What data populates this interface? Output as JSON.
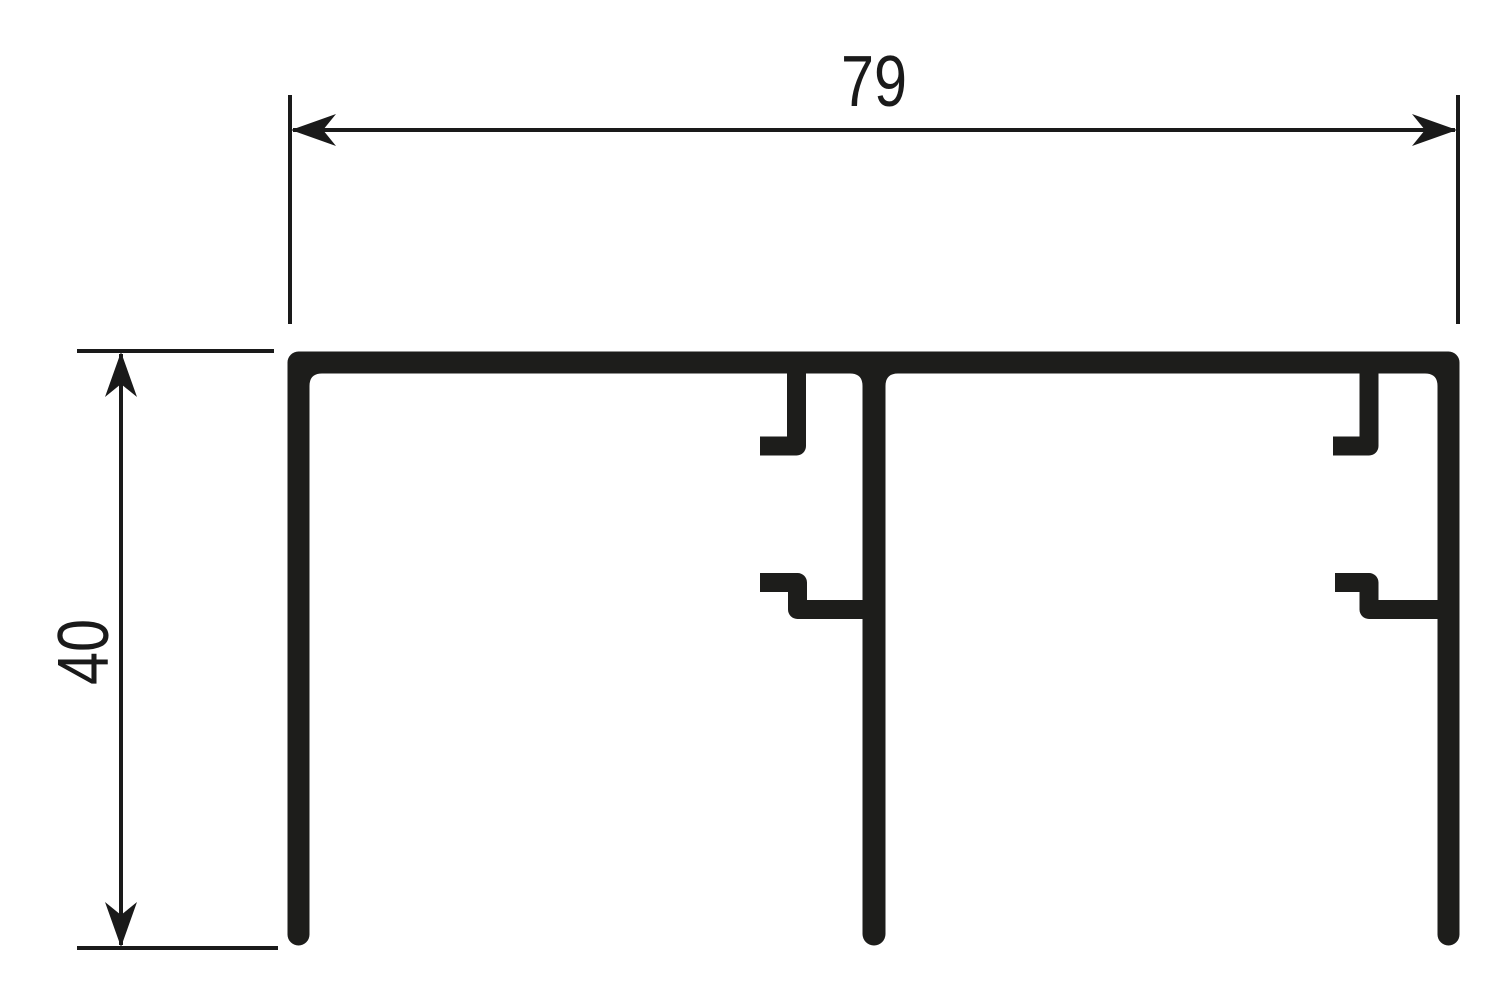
{
  "drawing": {
    "type": "technical-profile-cross-section",
    "labels": {
      "width": "79",
      "height": "40"
    },
    "colors": {
      "profile": "#1d1d1b",
      "dimension": "#1a1a1a",
      "background": "#ffffff"
    }
  }
}
